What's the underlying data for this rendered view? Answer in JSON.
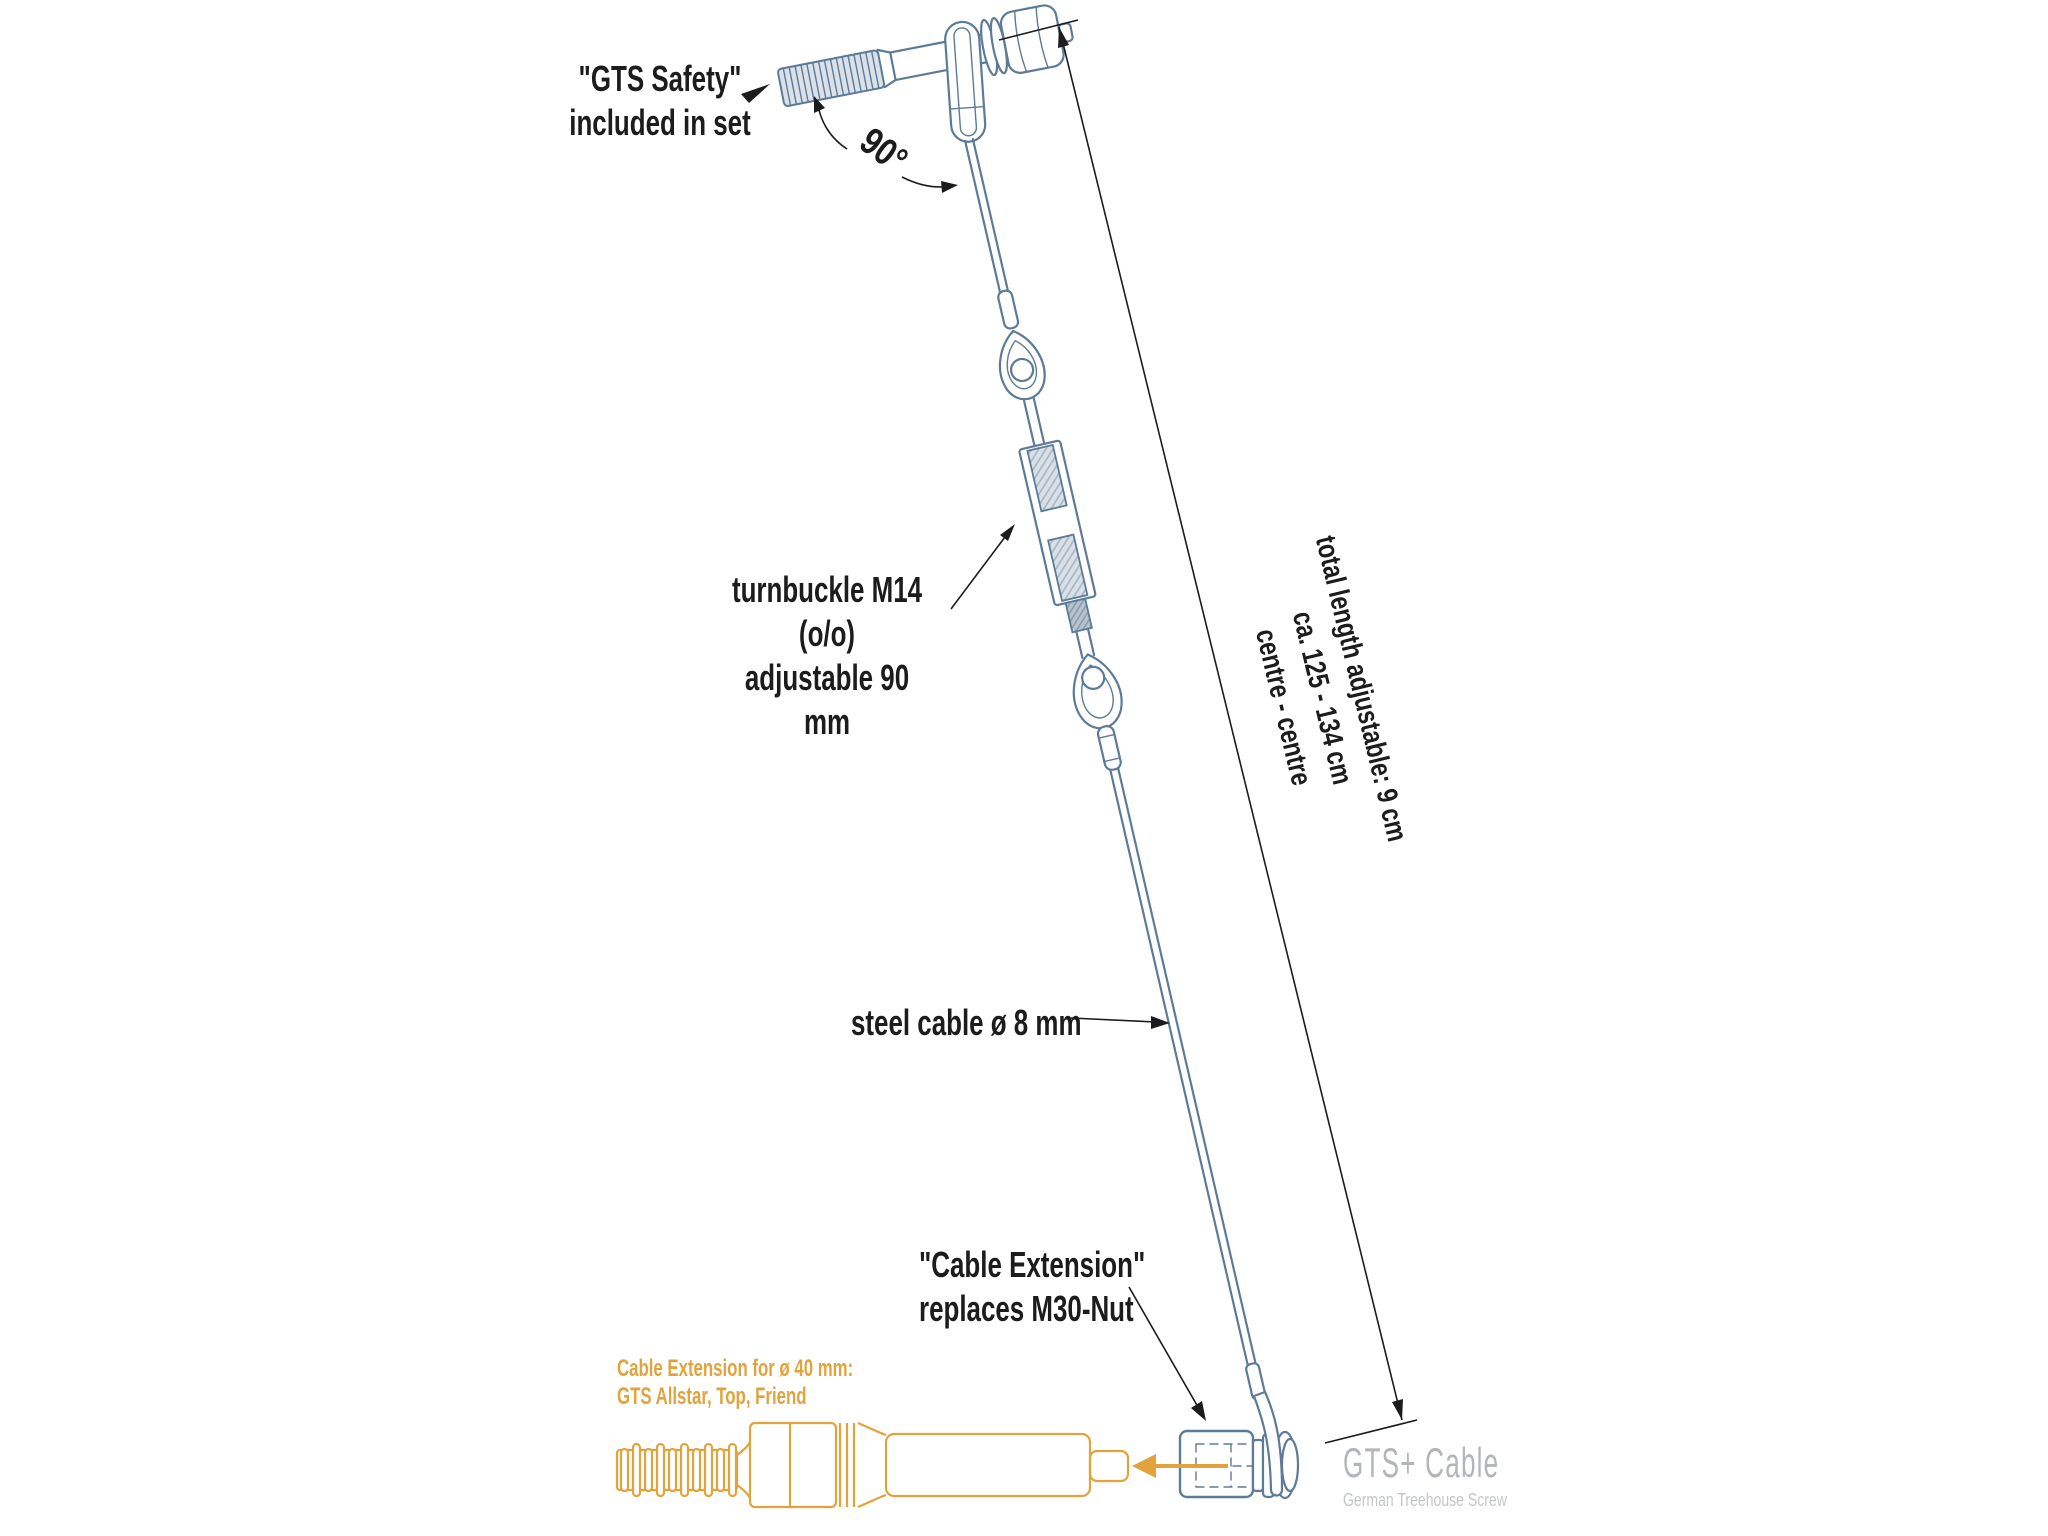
{
  "colors": {
    "background": "#ffffff",
    "ink": "#1c1c1c",
    "line": "#5d7b97",
    "thread_fill": "#dae1e8",
    "hatch_light_bg": "#d9e0e7",
    "hatch_light_line": "#a6b5c2",
    "hatch_dark_bg": "#b7c3cf",
    "hatch_dark_line": "#8799a9",
    "orange": "#e2a33d",
    "logo_primary": "#b2b6b9",
    "logo_secondary": "#c3c6c8"
  },
  "annotations": {
    "gts_safety": {
      "line1": "\"GTS Safety\"",
      "line2": "included in set"
    },
    "angle_label": "90°",
    "turnbuckle": {
      "line1": "turnbuckle M14 (o/o)",
      "line2": "adjustable 90 mm"
    },
    "total_length": {
      "line1": "total length adjustable: 9 cm",
      "line2": "ca. 125 - 134 cm",
      "line3": "centre - centre"
    },
    "steel_cable": "steel cable ø 8 mm",
    "cable_extension": {
      "line1": "\"Cable Extension\"",
      "line2": "replaces M30-Nut"
    },
    "orange_note": {
      "line1": "Cable Extension for ø 40 mm:",
      "line2": "GTS Allstar, Top, Friend"
    }
  },
  "logo": {
    "title": "GTS+ Cable",
    "subtitle": "German Treehouse Screw"
  }
}
